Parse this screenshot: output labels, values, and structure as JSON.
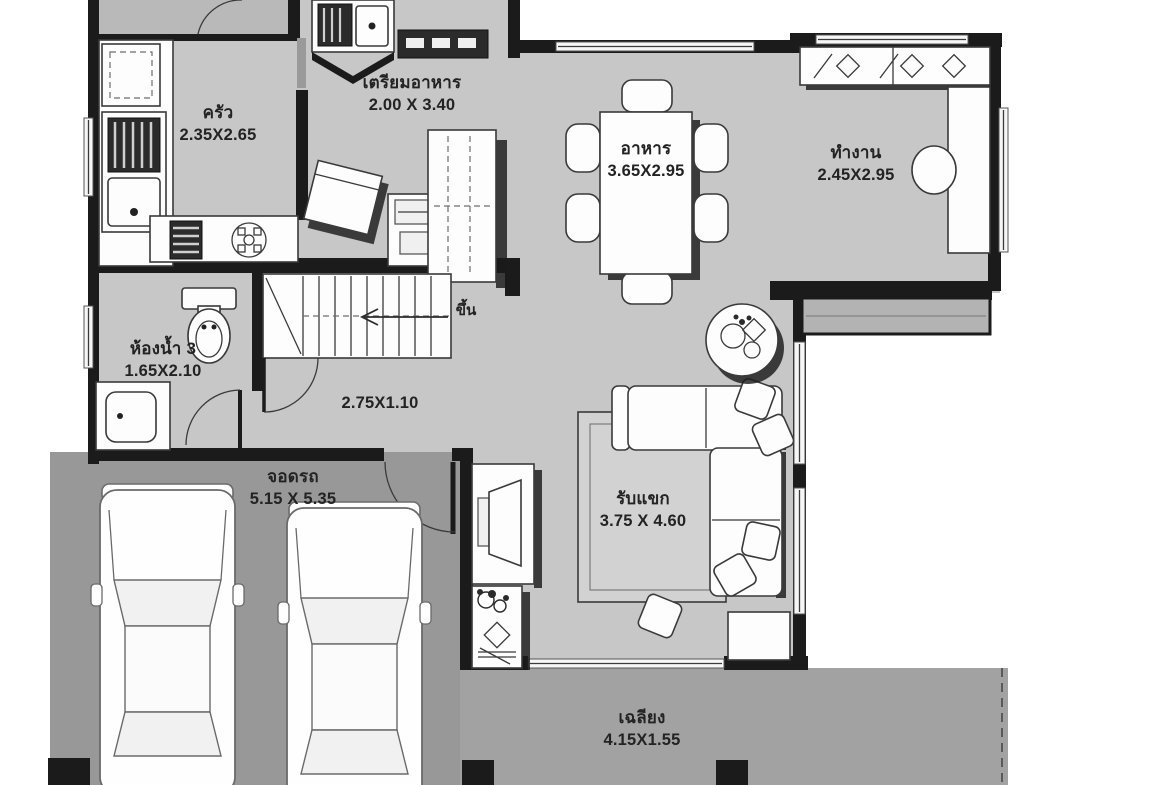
{
  "plan": {
    "rooms": [
      {
        "id": "kitchen",
        "name": "ครัว",
        "dim": "2.35X2.65"
      },
      {
        "id": "prep-kitchen",
        "name": "เตรียมอาหาร",
        "dim": "2.00 X 3.40"
      },
      {
        "id": "dining",
        "name": "อาหาร",
        "dim": "3.65X2.95"
      },
      {
        "id": "work",
        "name": "ทำงาน",
        "dim": "2.45X2.95"
      },
      {
        "id": "bathroom-3",
        "name": "ห้องน้ำ 3",
        "dim": "1.65X2.10"
      },
      {
        "id": "hallway",
        "name": "",
        "dim": "2.75X1.10"
      },
      {
        "id": "parking",
        "name": "จอดรถ",
        "dim": "5.15 X 5.35"
      },
      {
        "id": "living",
        "name": "รับแขก",
        "dim": "3.75 X 4.60"
      },
      {
        "id": "terrace",
        "name": "เฉลียง",
        "dim": "4.15X1.55"
      }
    ],
    "stairs": {
      "up_label": "ขึ้น"
    },
    "colors": {
      "floor": "#c7c7c7",
      "garage_floor": "#989898",
      "terrace_floor": "#a2a2a2",
      "wall": "#1b1b1b",
      "paper": "#ffffff"
    }
  }
}
